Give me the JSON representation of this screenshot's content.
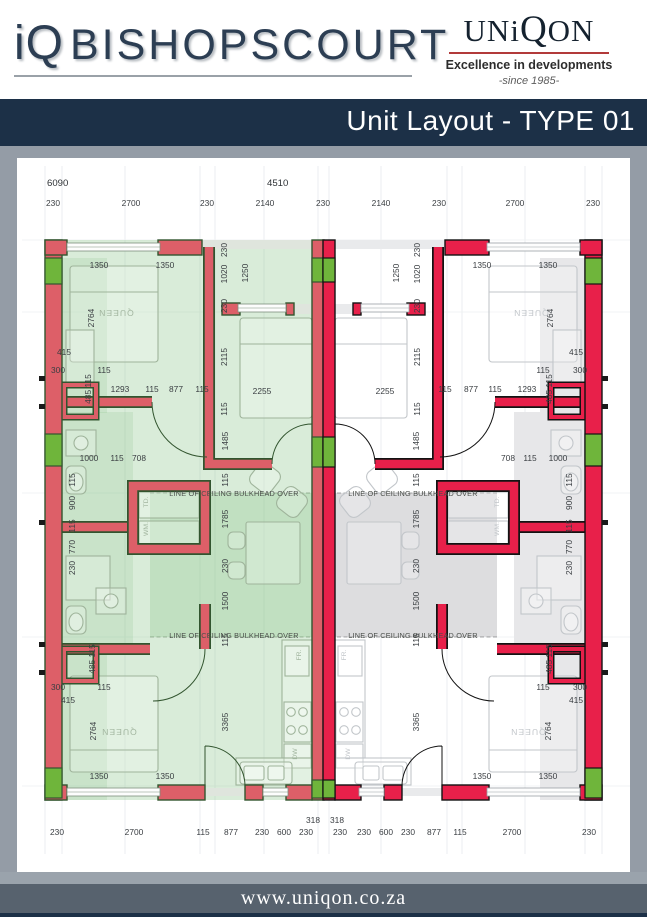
{
  "header": {
    "logo_iq": "iQ",
    "logo_name": "BISHOPSCOURT",
    "brand_name_a": "UN",
    "brand_name_b": "i",
    "brand_name_c": "Q",
    "brand_name_d": "ON",
    "brand_tagline": "Excellence in developments",
    "brand_since": "-since 1985-",
    "banner_title": "Unit Layout - TYPE 01"
  },
  "footer": {
    "website": "www.uniqon.co.za"
  },
  "plan": {
    "overall_dims": {
      "left": "6090",
      "right": "4510"
    },
    "top_row": [
      "230",
      "2700",
      "230",
      "2140",
      "230",
      "2140",
      "230",
      "2700",
      "230"
    ],
    "bottom_insets": [
      "318",
      "318"
    ],
    "bottom_row": [
      "230",
      "2700",
      "115",
      "877",
      "230",
      "600",
      "230",
      "230",
      "230",
      "600",
      "230",
      "877",
      "115",
      "2700",
      "230"
    ],
    "texts": {
      "bulkhead": "LINE OF CEILING BULKHEAD OVER",
      "queen": "QUEEN",
      "wm": "WM.",
      "td": "TD.",
      "fr": "FR.",
      "dw": "DW"
    },
    "dims": {
      "d1350": "1350",
      "d2764": "2764",
      "d415": "415",
      "d300": "300",
      "d115": "115",
      "d485_115": "485 115",
      "d1293": "1293",
      "d877": "877",
      "d1000": "1000",
      "d708": "708",
      "d900": "900",
      "d770": "770",
      "d230": "230",
      "d1020": "1020",
      "d1250": "1250",
      "d2115": "2115",
      "d2255": "2255",
      "d1485": "1485",
      "d1785": "1785",
      "d1500": "1500",
      "d3365": "3365"
    }
  }
}
